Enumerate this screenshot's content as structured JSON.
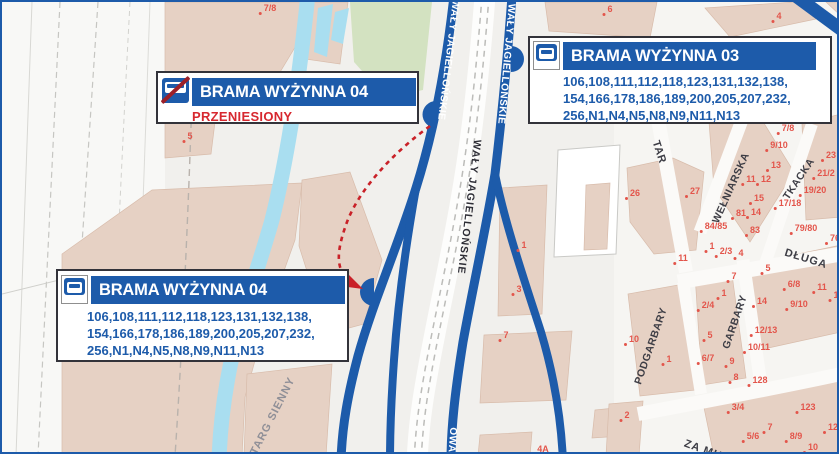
{
  "map": {
    "colors": {
      "road_blue": "#1d5baa",
      "label_blue": "#1d5baa",
      "status_red": "#d7282f",
      "arrow_red": "#c92128",
      "number_red": "#e3554b",
      "canal_blue": "#a9def0",
      "building_tan": "#e6d1c4",
      "park_green": "#d3e2c1"
    },
    "callouts": {
      "old_stop": {
        "title": "BRAMA WYŻYNNA 04",
        "status": "PRZENIESIONY",
        "icon": "bus-stop-crossed-icon"
      },
      "stop03": {
        "title": "BRAMA WYŻYNNA 03",
        "icon": "bus-stop-icon",
        "routes": [
          "106,108,111,112,118,123,131,132,138,",
          "154,166,178,186,189,200,205,207,232,",
          "256,N1,N4,N5,N8,N9,N11,N13"
        ]
      },
      "stop04": {
        "title": "BRAMA WYŻYNNA 04",
        "icon": "bus-stop-icon",
        "routes": [
          "106,108,111,112,118,123,131,132,138,",
          "154,166,178,186,189,200,205,207,232,",
          "256,N1,N4,N5,N8,N9,N11,N13"
        ]
      }
    },
    "streets": [
      {
        "t": "WAŁY JAGIELLOŃSKIE",
        "x": 467,
        "y": 205,
        "r": 97,
        "c": "#2e2e36",
        "s": 10.5,
        "ls": 1
      },
      {
        "t": "WAŁY JAGIELLOŃSKIE",
        "x": 446,
        "y": 58,
        "r": 97,
        "c": "#ffffff",
        "s": 10,
        "ls": 0.5
      },
      {
        "t": "WAŁY JAGIELLOŃSKIE",
        "x": 504,
        "y": 62,
        "r": 95,
        "c": "#ffffff",
        "s": 10,
        "ls": 0.5
      },
      {
        "t": "OWA",
        "x": 450,
        "y": 438,
        "r": 94,
        "c": "#ffffff",
        "s": 10,
        "ls": 0.5
      },
      {
        "t": "TARG SIENNY",
        "x": 271,
        "y": 414,
        "r": -63,
        "c": "#8f8f97",
        "s": 11,
        "ls": 1
      },
      {
        "t": "TAR",
        "x": 657,
        "y": 150,
        "r": 72,
        "c": "#3d3d45",
        "s": 11,
        "ls": 0.5
      },
      {
        "t": "WEŁNIARSKA",
        "x": 729,
        "y": 186,
        "r": -66,
        "c": "#3d3d45",
        "s": 10.5,
        "ls": 0.5
      },
      {
        "t": "TKACKA",
        "x": 797,
        "y": 177,
        "r": -56,
        "c": "#3d3d45",
        "s": 10.5,
        "ls": 0.5
      },
      {
        "t": "DŁUGA",
        "x": 804,
        "y": 257,
        "r": 17,
        "c": "#3d3d45",
        "s": 11,
        "ls": 1
      },
      {
        "t": "GARBARY",
        "x": 733,
        "y": 320,
        "r": -71,
        "c": "#3d3d45",
        "s": 10.5,
        "ls": 0.5
      },
      {
        "t": "PODGARBARY",
        "x": 649,
        "y": 344,
        "r": -71,
        "c": "#3d3d45",
        "s": 10.5,
        "ls": 0.5
      },
      {
        "t": "ZA MU",
        "x": 701,
        "y": 448,
        "r": 20,
        "c": "#3d3d45",
        "s": 11,
        "ls": 1
      }
    ],
    "building_numbers": [
      [
        "7/8",
        268,
        6
      ],
      [
        "5",
        188,
        134
      ],
      [
        "6",
        608,
        7
      ],
      [
        "4",
        777,
        14
      ],
      [
        "7/8",
        786,
        126
      ],
      [
        "9/10",
        777,
        143
      ],
      [
        "13",
        774,
        163
      ],
      [
        "11",
        749,
        177
      ],
      [
        "12",
        764,
        177
      ],
      [
        "23",
        829,
        153
      ],
      [
        "21/2",
        824,
        171
      ],
      [
        "19/20",
        813,
        188
      ],
      [
        "15",
        757,
        196
      ],
      [
        "17/18",
        788,
        201
      ],
      [
        "14",
        754,
        210
      ],
      [
        "81",
        739,
        211
      ],
      [
        "27",
        693,
        189
      ],
      [
        "26",
        633,
        191
      ],
      [
        "84/85",
        714,
        224
      ],
      [
        "83",
        753,
        228
      ],
      [
        "79/80",
        804,
        226
      ],
      [
        "76",
        833,
        236
      ],
      [
        "1",
        710,
        244
      ],
      [
        "2/3",
        724,
        249
      ],
      [
        "4",
        739,
        251
      ],
      [
        "11",
        681,
        256
      ],
      [
        "5",
        766,
        266
      ],
      [
        "1",
        522,
        243
      ],
      [
        "3",
        517,
        287
      ],
      [
        "7",
        504,
        333
      ],
      [
        "4A",
        541,
        447
      ],
      [
        "7",
        732,
        274
      ],
      [
        "1",
        722,
        291
      ],
      [
        "2/4",
        706,
        303
      ],
      [
        "6/8",
        792,
        282
      ],
      [
        "11",
        820,
        285
      ],
      [
        "1",
        834,
        293
      ],
      [
        "9/10",
        797,
        302
      ],
      [
        "14",
        760,
        299
      ],
      [
        "12/13",
        764,
        328
      ],
      [
        "10/11",
        757,
        345
      ],
      [
        "5",
        708,
        333
      ],
      [
        "10",
        632,
        337
      ],
      [
        "1",
        667,
        357
      ],
      [
        "6/7",
        706,
        356
      ],
      [
        "9",
        730,
        359
      ],
      [
        "8",
        734,
        375
      ],
      [
        "128",
        758,
        378
      ],
      [
        "3/4",
        736,
        405
      ],
      [
        "123",
        806,
        405
      ],
      [
        "2",
        625,
        413
      ],
      [
        "7",
        768,
        425
      ],
      [
        "5/6",
        751,
        434
      ],
      [
        "8/9",
        794,
        434
      ],
      [
        "10",
        811,
        445
      ],
      [
        "12",
        831,
        425
      ]
    ]
  }
}
